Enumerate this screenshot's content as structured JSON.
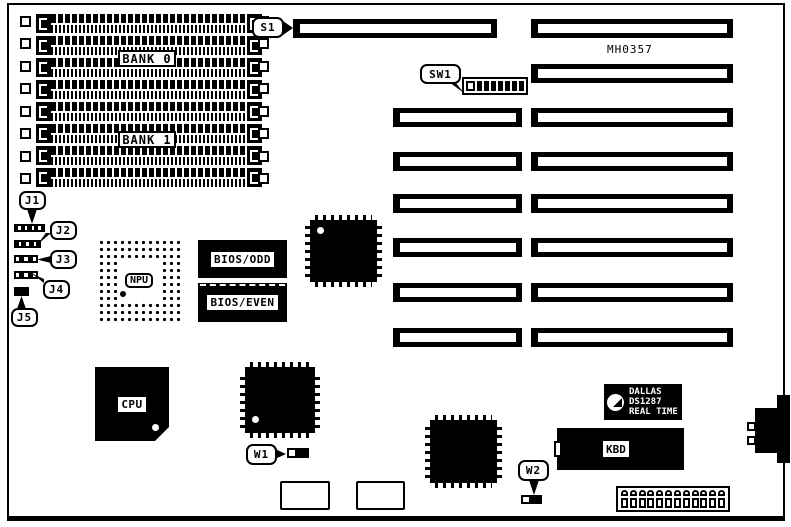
{
  "board": {
    "part_number": "MH0357",
    "ink": "#000000",
    "paper": "#ffffff"
  },
  "memory": {
    "bank0_label": "BANK 0",
    "bank1_label": "BANK 1",
    "row_count": 8,
    "side_tab_count": 8
  },
  "slots": {
    "s1_label": "S1",
    "full_length_count": 8,
    "extension_count": 6
  },
  "dip_switch": {
    "label": "SW1",
    "cells": "wbbbbbbb"
  },
  "jumpers": {
    "j1": {
      "label": "J1",
      "cells": "bwbwbwbwb"
    },
    "j2": {
      "label": "J2",
      "cells": "bwbwbwb"
    },
    "j3": {
      "label": "J3",
      "cells": "wbwbw"
    },
    "j4": {
      "label": "J4",
      "cells": "wbwbw"
    },
    "j5": {
      "label": "J5",
      "cells": "bb"
    },
    "w1": {
      "label": "W1",
      "cells": "wbb"
    },
    "w2": {
      "label": "W2",
      "cells": "wbb"
    }
  },
  "chips": {
    "npu_label": "NPU",
    "cpu_label": "CPU",
    "bios_odd_label": "BIOS/ODD",
    "bios_even_label": "BIOS/EVEN",
    "kbd_label": "KBD",
    "rtc_line1": "DALLAS",
    "rtc_line2": "DS1287",
    "rtc_line3": "REAL TIME"
  },
  "power_connector": {
    "pin_count": 12
  }
}
